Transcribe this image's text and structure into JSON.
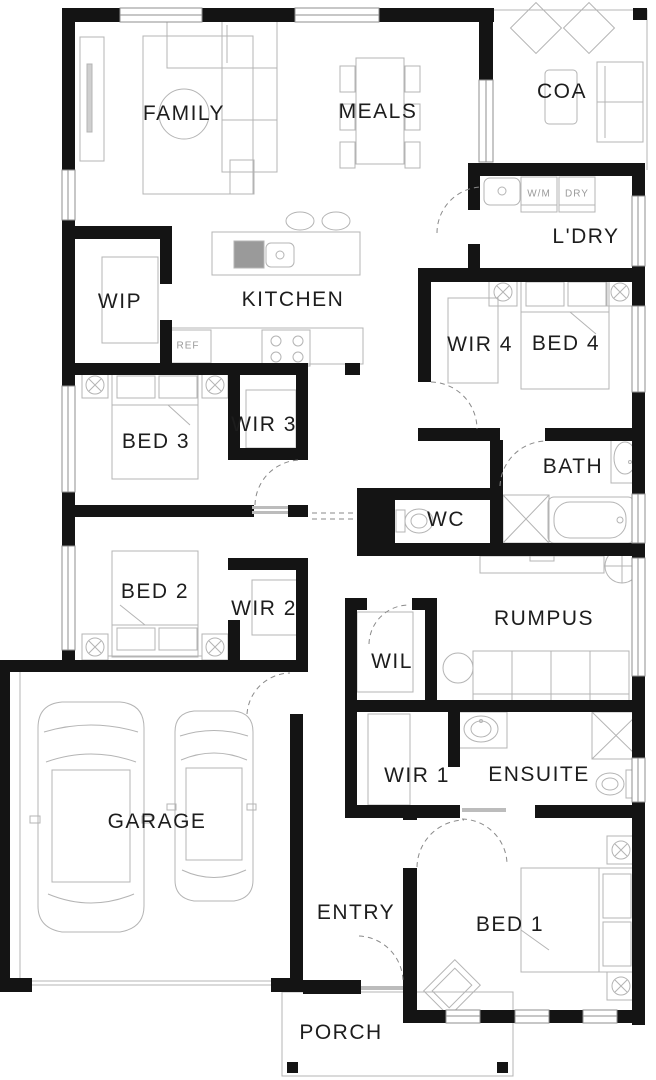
{
  "rooms": {
    "family": "FAMILY",
    "meals": "MEALS",
    "coa": "COA",
    "ldry": "L'DRY",
    "wip": "WIP",
    "kitchen": "KITCHEN",
    "wir4": "WIR 4",
    "bed4": "BED 4",
    "bed3": "BED 3",
    "wir3": "WIR 3",
    "bath": "BATH",
    "wc": "WC",
    "bed2": "BED 2",
    "wir2": "WIR 2",
    "rumpus": "RUMPUS",
    "wil": "WIL",
    "garage": "GARAGE",
    "wir1": "WIR 1",
    "ensuite": "ENSUITE",
    "entry": "ENTRY",
    "bed1": "BED 1",
    "porch": "PORCH"
  },
  "appliances": {
    "wm": "W/M",
    "dry": "DRY",
    "ref": "REF"
  },
  "colors": {
    "wall": "#141414",
    "furniture_outline": "#b4b4b4",
    "door_swing": "#8a8a8a",
    "label": "#1d1d1d",
    "background": "#ffffff"
  }
}
